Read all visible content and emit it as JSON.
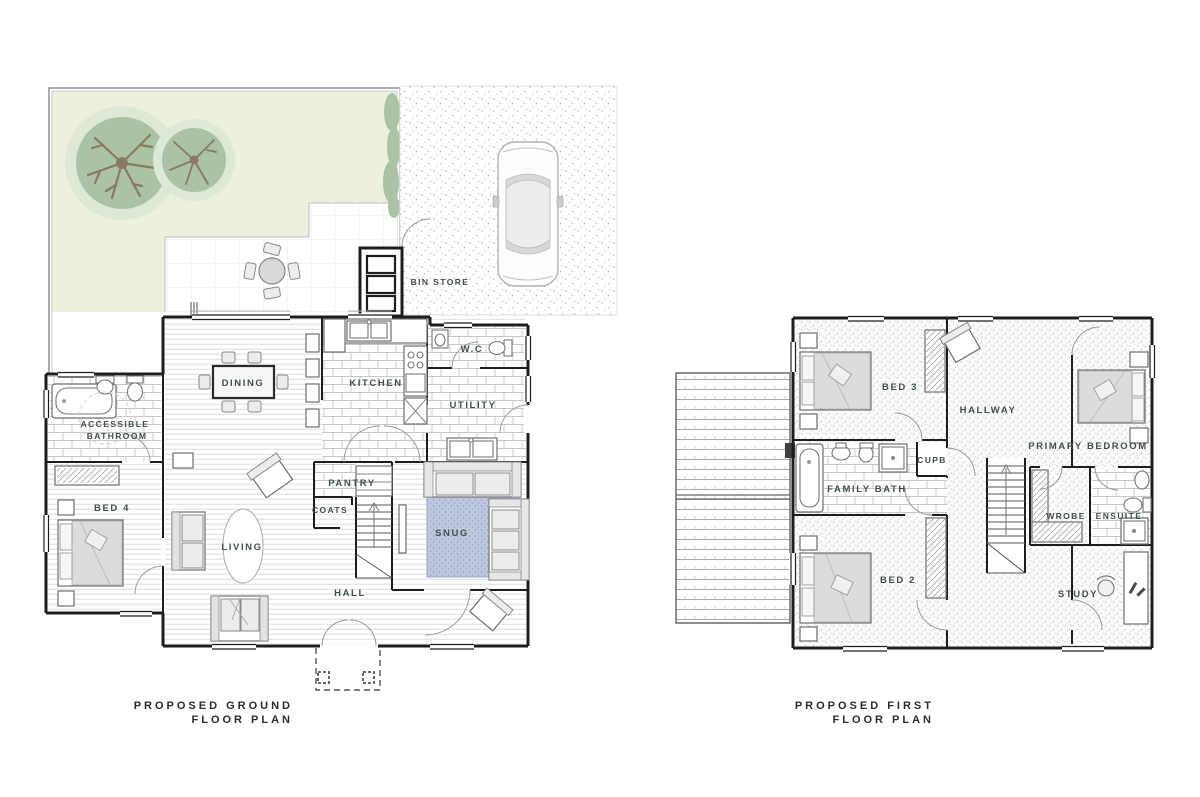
{
  "canvas": {
    "width": 1200,
    "height": 797,
    "background": "#ffffff"
  },
  "colors": {
    "garden_green": "#edf0dd",
    "tree_green": "#a9c3a4",
    "tree_green_light": "#dde9d6",
    "tree_trunk": "#8b7a5f",
    "hedge_green": "#a9c3a4",
    "rug_blue": "#bfc7de",
    "wall": "#1d1d1d",
    "label_color": "#41504a",
    "title_color": "#2b2b2b"
  },
  "ground_floor": {
    "title_line1": "PROPOSED GROUND",
    "title_line2": "FLOOR PLAN",
    "labels": {
      "bin_store": "BIN STORE",
      "dining": "DINING",
      "kitchen": "KITCHEN",
      "wc": "W.C",
      "utility": "UTILITY",
      "pantry": "PANTRY",
      "coats": "COATS",
      "living": "LIVING",
      "snug": "SNUG",
      "hall": "HALL",
      "bed4": "BED 4",
      "accessible_bathroom_line1": "ACCESSIBLE",
      "accessible_bathroom_line2": "BATHROOM"
    }
  },
  "first_floor": {
    "title_line1": "PROPOSED FIRST",
    "title_line2": "FLOOR PLAN",
    "labels": {
      "bed3": "BED 3",
      "hallway": "HALLWAY",
      "primary_bedroom": "PRIMARY BEDROOM",
      "cupb": "CUPB",
      "family_bath": "FAMILY BATH",
      "wrobe": "WROBE",
      "ensuite": "ENSUITE",
      "bed2": "BED 2",
      "study": "STUDY"
    }
  }
}
